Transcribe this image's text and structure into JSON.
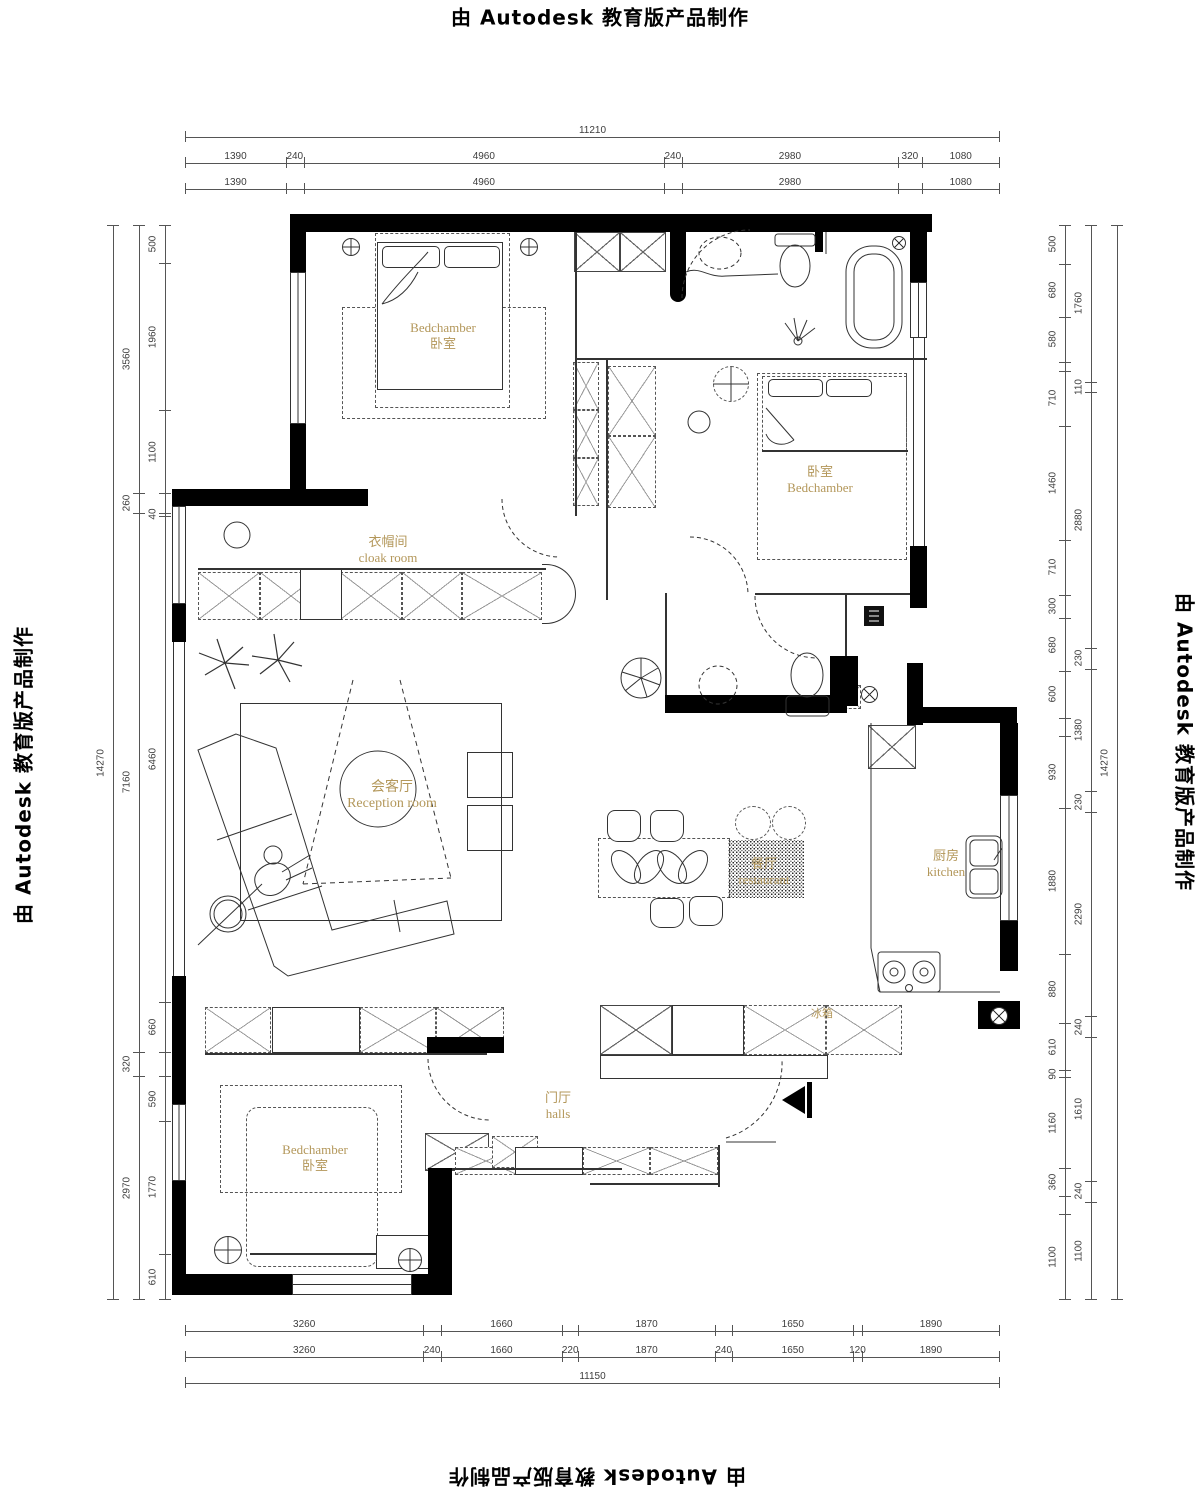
{
  "watermark": {
    "prefix": "由",
    "brand": "Autodesk",
    "suffix": "教育版产品制作"
  },
  "rooms": {
    "bedroom_top_left": {
      "en": "Bedchamber",
      "zh": "卧室"
    },
    "bedroom_right": {
      "zh": "卧室",
      "en": "Bedchamber"
    },
    "bedroom_bottom_left": {
      "en": "Bedchamber",
      "zh": "卧室"
    },
    "cloak_room": {
      "zh": "衣帽间",
      "en": "cloak room"
    },
    "reception_room": {
      "zh": "会客厅",
      "en": "Reception room"
    },
    "restaurant": {
      "zh": "餐厅",
      "en": "restaurant"
    },
    "kitchen": {
      "zh": "厨房",
      "en": "kitchen"
    },
    "halls": {
      "zh": "门厅",
      "en": "halls"
    },
    "fridge": {
      "zh": "冰箱"
    }
  },
  "dimensions": {
    "top": {
      "rows": [
        [
          [
            11210,
            "11210"
          ]
        ],
        [
          [
            1390,
            "1390"
          ],
          [
            240,
            "240"
          ],
          [
            4960,
            "4960"
          ],
          [
            240,
            "240"
          ],
          [
            2980,
            "2980"
          ],
          [
            320,
            "320"
          ],
          [
            1080,
            "1080"
          ]
        ],
        [
          [
            1390,
            "1390"
          ],
          [
            240,
            ""
          ],
          [
            4960,
            "4960"
          ],
          [
            240,
            ""
          ],
          [
            2980,
            "2980"
          ],
          [
            320,
            ""
          ],
          [
            1080,
            "1080"
          ]
        ]
      ]
    },
    "bottom": {
      "rows": [
        [
          [
            3260,
            "3260"
          ],
          [
            240,
            ""
          ],
          [
            1660,
            "1660"
          ],
          [
            220,
            ""
          ],
          [
            1870,
            "1870"
          ],
          [
            240,
            ""
          ],
          [
            1650,
            "1650"
          ],
          [
            120,
            ""
          ],
          [
            1890,
            "1890"
          ]
        ],
        [
          [
            3260,
            "3260"
          ],
          [
            240,
            "240"
          ],
          [
            1660,
            "1660"
          ],
          [
            220,
            "220"
          ],
          [
            1870,
            "1870"
          ],
          [
            240,
            "240"
          ],
          [
            1650,
            "1650"
          ],
          [
            120,
            "120"
          ],
          [
            1890,
            "1890"
          ]
        ],
        [
          [
            11150,
            "11150"
          ]
        ]
      ]
    },
    "left": {
      "cols": [
        [
          [
            14270,
            "14270"
          ]
        ],
        [
          [
            3560,
            "3560"
          ],
          [
            260,
            "260"
          ],
          [
            7160,
            "7160"
          ],
          [
            320,
            "320"
          ],
          [
            2970,
            "2970"
          ]
        ],
        [
          [
            500,
            "500"
          ],
          [
            1960,
            "1960"
          ],
          [
            1100,
            "1100"
          ],
          [
            260,
            ""
          ],
          [
            40,
            "40"
          ],
          [
            6460,
            "6460"
          ],
          [
            660,
            "660"
          ],
          [
            320,
            ""
          ],
          [
            590,
            "590"
          ],
          [
            1770,
            "1770"
          ],
          [
            610,
            "610"
          ]
        ]
      ]
    },
    "right": {
      "cols": [
        [
          [
            500,
            "500"
          ],
          [
            680,
            "680"
          ],
          [
            580,
            "580"
          ],
          [
            110,
            ""
          ],
          [
            710,
            "710"
          ],
          [
            1460,
            "1460"
          ],
          [
            710,
            "710"
          ],
          [
            300,
            "300"
          ],
          [
            680,
            "680"
          ],
          [
            600,
            "600"
          ],
          [
            230,
            ""
          ],
          [
            930,
            "930"
          ],
          [
            1880,
            "1880"
          ],
          [
            880,
            "880"
          ],
          [
            610,
            "610"
          ],
          [
            90,
            "90"
          ],
          [
            1160,
            "1160"
          ],
          [
            360,
            "360"
          ],
          [
            240,
            ""
          ],
          [
            1100,
            "1100"
          ]
        ],
        [
          [
            1760,
            "1760"
          ],
          [
            110,
            "110"
          ],
          [
            2880,
            "2880"
          ],
          [
            230,
            "230"
          ],
          [
            1380,
            "1380"
          ],
          [
            230,
            "230"
          ],
          [
            2290,
            "2290"
          ],
          [
            240,
            "240"
          ],
          [
            1610,
            "1610"
          ],
          [
            240,
            "240"
          ],
          [
            1100,
            "1100"
          ]
        ],
        [
          [
            14270,
            "14270"
          ]
        ]
      ]
    }
  },
  "colors": {
    "wall": "#000000",
    "line": "#333333",
    "room_label": "#b3975a",
    "dim_text": "#3d3d3d"
  }
}
